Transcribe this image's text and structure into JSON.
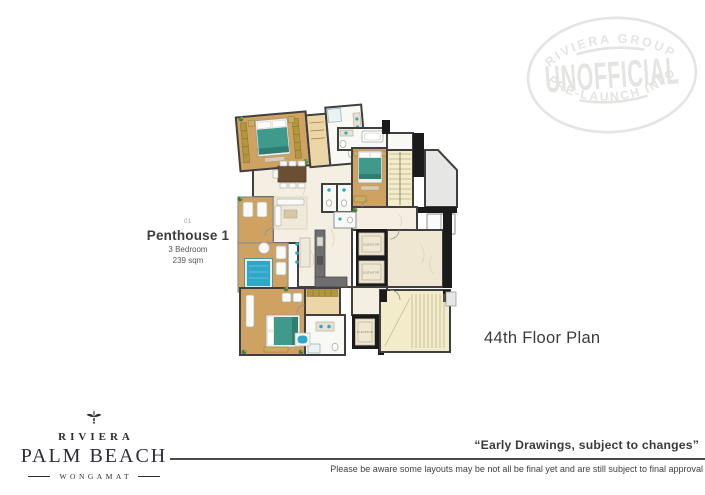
{
  "colors": {
    "wood": "#cfa261",
    "wood_light": "#ecd6a8",
    "marble": "#f4efe2",
    "marble_dark": "#efe7d2",
    "stair": "#f2ecca",
    "gray_zone": "#e6e6e5",
    "bath": "#f8f8f5",
    "pool": "#2fa7c9",
    "bed": "#3f9a8b",
    "bed_dark": "#2e7f72",
    "wardrobe": "#b0973f",
    "wall": "#3f3f3f",
    "black": "#1b1b1b",
    "plant": "#4d7a3b",
    "stamp": "#e4e4e2"
  },
  "stamp": {
    "top_text": "RIVIERA GROUP",
    "center_text": "UNOFFICIAL",
    "bottom_text": "PRE-LAUNCH INFO"
  },
  "unit": {
    "number": "01",
    "name": "Penthouse 1",
    "bedrooms": "3 Bedroom",
    "area": "239 sqm"
  },
  "floor_label": "44th Floor Plan",
  "floor_plan": {
    "elevator_label": "ELEVATOR"
  },
  "brand": {
    "name": "RIVIERA",
    "title": "PALM BEACH",
    "subtitle": "WONGAMAT"
  },
  "footer": {
    "quote": "“Early Drawings, subject to changes”",
    "disclaimer": "Please be aware some layouts may be not all be final yet and are still subject to final approval"
  }
}
